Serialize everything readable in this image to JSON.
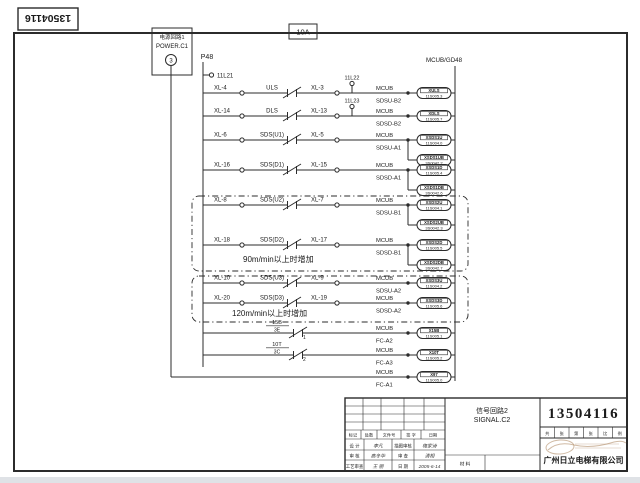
{
  "page": {
    "line_color": "#2b2b2b",
    "ink_color": "#1a1a1a",
    "strip_color": "#dfe2e6"
  },
  "corner_number": "13504116",
  "fuse_label": "10A",
  "power_box": {
    "line1": "电源回路1",
    "line2": "POWER.C1",
    "circle": "3"
  },
  "left_bus_label": "P48",
  "right_bus_label": "MCUB/GD48",
  "stub_top": "11L21",
  "captions": {
    "group90": "90m/min以上时增加",
    "group120": "120m/min以上时增加"
  },
  "rows": [
    {
      "y": 93,
      "xl_left": "XL-4",
      "contact": "ULS",
      "xl_right": "XL-3",
      "stub": "11L22",
      "mcub": "MCUB",
      "net": "SDSU-B2",
      "boxes": [
        {
          "label": "XULS",
          "ref": "11S005.3"
        }
      ]
    },
    {
      "y": 116,
      "xl_left": "XL-14",
      "contact": "DLS",
      "xl_right": "XL-13",
      "stub": "11L23",
      "mcub": "MCUB",
      "net": "SDSD-B2",
      "boxes": [
        {
          "label": "XDLS",
          "ref": "11S005.7"
        }
      ]
    },
    {
      "y": 140,
      "xl_left": "XL-6",
      "contact": "SDS(U1)",
      "xl_right": "XL-5",
      "mcub": "MCUB",
      "net": "SDSU-A1",
      "boxes": [
        {
          "label": "XSDS1U",
          "ref": "11S004.0"
        },
        {
          "label": "XSDS1UB",
          "ref": "3S0042.2",
          "dy": 20
        }
      ]
    },
    {
      "y": 170,
      "xl_left": "XL-16",
      "contact": "SDS(D1)",
      "xl_right": "XL-15",
      "mcub": "MCUB",
      "net": "SDSD-A1",
      "boxes": [
        {
          "label": "XSDS1D",
          "ref": "11S005.4"
        },
        {
          "label": "XSDS1DB",
          "ref": "3S0042.6",
          "dy": 20
        }
      ]
    },
    {
      "y": 205,
      "xl_left": "XL-8",
      "contact": "SDS(U2)",
      "xl_right": "XL-7",
      "mcub": "MCUB",
      "net": "SDSU-B1",
      "boxes": [
        {
          "label": "XSDS2U",
          "ref": "11S004.1"
        },
        {
          "label": "XSDS2UB",
          "ref": "3S0042.3",
          "dy": 20
        }
      ]
    },
    {
      "y": 245,
      "xl_left": "XL-18",
      "contact": "SDS(D2)",
      "xl_right": "XL-17",
      "mcub": "MCUB",
      "net": "SDSD-B1",
      "boxes": [
        {
          "label": "XSDS2D",
          "ref": "11S005.5"
        },
        {
          "label": "XSDS2DB",
          "ref": "3S0042.7",
          "dy": 20
        }
      ]
    },
    {
      "y": 283,
      "xl_left": "XL-10",
      "contact": "SDS(U3)",
      "xl_right": "XL-9",
      "mcub": "MCUB",
      "net": "SDSU-A2",
      "boxes": [
        {
          "label": "XSDS3U",
          "ref": "11S004.2"
        }
      ]
    },
    {
      "y": 303,
      "xl_left": "XL-20",
      "contact": "SDS(D3)",
      "xl_right": "XL-19",
      "mcub": "MCUB",
      "net": "SDSD-A2",
      "boxes": [
        {
          "label": "XSDS3D",
          "ref": "11S005.6"
        }
      ]
    },
    {
      "y": 333,
      "frac_top": "15B",
      "frac_bot": "3E",
      "pin": "1",
      "mcub": "MCUB",
      "net": "FC-A2",
      "boxes": [
        {
          "label": "X15B",
          "ref": "11S005.1"
        }
      ]
    },
    {
      "y": 355,
      "frac_top": "10T",
      "frac_bot": "3C",
      "pin": "2",
      "mcub": "MCUB",
      "net": "FC-A3",
      "boxes": [
        {
          "label": "X10T",
          "ref": "11S005.2"
        }
      ]
    },
    {
      "y": 377,
      "start_x": 171,
      "mcub": "MCUB",
      "net": "FC-A1",
      "boxes": [
        {
          "label": "X97",
          "ref": "11S005.0"
        }
      ]
    }
  ],
  "title_block": {
    "title_cn": "信号回路2",
    "title_en": "SIGNAL.C2",
    "drawing_no": "13504116",
    "company": "广州日立电梯有限公司",
    "material_label": "材 料",
    "header_cells": [
      "标记",
      "处数",
      "文件号",
      "签 字",
      "日期"
    ],
    "sign_rows": [
      [
        "设 计",
        "李凡",
        "描图审核",
        "梅家诗"
      ],
      [
        "审 核",
        "高冬毕",
        "审 查",
        "清相"
      ],
      [
        "工艺审查",
        "王 丽",
        "日 期",
        "2005-6-14"
      ]
    ],
    "small_cells": [
      "共",
      "张",
      "第",
      "张",
      "比",
      "例"
    ]
  }
}
